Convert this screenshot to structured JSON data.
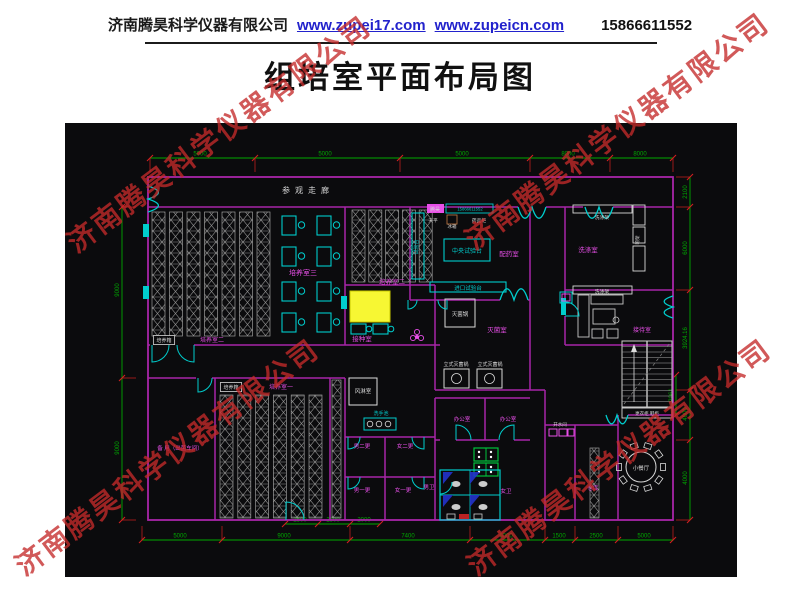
{
  "header": {
    "company": "济南腾昊科学仪器有限公司",
    "links": [
      "www.zupei17.com",
      "www.zupeicn.com"
    ],
    "phone": "15866611552"
  },
  "title": "组培室平面布局图",
  "watermark": {
    "text": "济南腾昊科学仪器有限公司",
    "color": "#c42a2a"
  },
  "plan": {
    "colors": {
      "wall": "#a825a8",
      "cyan": "#00cdcd",
      "dim": "#00a800",
      "tick": "#d42020",
      "white": "#d8d8d8",
      "magenta": "#e84fe8",
      "yellow": "#f7f733",
      "rack": "#9a9a9a",
      "blue": "#2233cc",
      "greenfurn": "#00c23a",
      "canvas": "#0b0b0d"
    },
    "labels": [
      {
        "t": "参观走廊",
        "x": 308,
        "y": 193,
        "c": "w",
        "s": 8,
        "ls": 5
      },
      {
        "t": "培养室三",
        "x": 303,
        "y": 275,
        "c": "m",
        "s": 7
      },
      {
        "t": "培养室二",
        "x": 392,
        "y": 284,
        "c": "m",
        "s": 6.5
      },
      {
        "t": "培养箱",
        "x": 164,
        "y": 342,
        "c": "w",
        "s": 5,
        "box": 1
      },
      {
        "t": "培养室二",
        "x": 212,
        "y": 342,
        "c": "m",
        "s": 6
      },
      {
        "t": "培养箱",
        "x": 231,
        "y": 389,
        "c": "w",
        "s": 5,
        "box": 1
      },
      {
        "t": "培养室一",
        "x": 281,
        "y": 389,
        "c": "m",
        "s": 6
      },
      {
        "t": "备 用（出菌车间）",
        "x": 180,
        "y": 450,
        "c": "m",
        "s": 5.5
      },
      {
        "t": "接种室",
        "x": 362,
        "y": 341,
        "c": "m",
        "s": 6.5
      },
      {
        "t": "灭菌锅",
        "x": 460,
        "y": 316,
        "c": "w",
        "s": 5.5
      },
      {
        "t": "灭菌室",
        "x": 497,
        "y": 332,
        "c": "m",
        "s": 6.5
      },
      {
        "t": "立式灭菌锅",
        "x": 456,
        "y": 366,
        "c": "w",
        "s": 5
      },
      {
        "t": "立式灭菌锅",
        "x": 490,
        "y": 366,
        "c": "w",
        "s": 5
      },
      {
        "t": "配药室",
        "x": 509,
        "y": 256,
        "c": "m",
        "s": 6.5
      },
      {
        "t": "中央试验台",
        "x": 467,
        "y": 253,
        "c": "cy",
        "s": 6
      },
      {
        "t": "进口试验台",
        "x": 468,
        "y": 290,
        "c": "cy",
        "s": 5.5
      },
      {
        "t": "试验台",
        "x": 418,
        "y": 247,
        "c": "cy",
        "s": 5,
        "r": -90
      },
      {
        "t": "天平",
        "x": 433,
        "y": 222,
        "c": "w",
        "s": 4.8
      },
      {
        "t": "冰箱",
        "x": 452,
        "y": 228,
        "c": "w",
        "s": 4.5
      },
      {
        "t": "药品柜",
        "x": 479,
        "y": 222,
        "c": "w",
        "s": 4.8
      },
      {
        "t": "腾昊",
        "x": 435,
        "y": 211,
        "c": "w",
        "s": 5
      },
      {
        "t": "15866611552",
        "x": 470,
        "y": 210.5,
        "c": "cy",
        "s": 4.2
      },
      {
        "t": "洗涤室",
        "x": 588,
        "y": 252,
        "c": "m",
        "s": 6.5
      },
      {
        "t": "洗涤架",
        "x": 602,
        "y": 219,
        "c": "w",
        "s": 4.8
      },
      {
        "t": "洗涤架",
        "x": 602,
        "y": 293,
        "c": "w",
        "s": 4.8
      },
      {
        "t": "晾架",
        "x": 639,
        "y": 240,
        "c": "w",
        "s": 4.5,
        "r": -90
      },
      {
        "t": "接待室",
        "x": 642,
        "y": 332,
        "c": "m",
        "s": 6
      },
      {
        "t": "更衣柜 鞋柜",
        "x": 647,
        "y": 415,
        "c": "w",
        "s": 4.5
      },
      {
        "t": "风淋室",
        "x": 363,
        "y": 393,
        "c": "w",
        "s": 5.5
      },
      {
        "t": "洗手池",
        "x": 381,
        "y": 415,
        "c": "cy",
        "s": 5
      },
      {
        "t": "男二更",
        "x": 362,
        "y": 448,
        "c": "m",
        "s": 5.5
      },
      {
        "t": "女二更",
        "x": 405,
        "y": 448,
        "c": "m",
        "s": 5.5
      },
      {
        "t": "男一更",
        "x": 362,
        "y": 492,
        "c": "m",
        "s": 5.5
      },
      {
        "t": "女一更",
        "x": 403,
        "y": 492,
        "c": "m",
        "s": 5.5
      },
      {
        "t": "办公室",
        "x": 462,
        "y": 421,
        "c": "m",
        "s": 5.5
      },
      {
        "t": "办公室",
        "x": 508,
        "y": 421,
        "c": "m",
        "s": 5.5
      },
      {
        "t": "男卫",
        "x": 429,
        "y": 489,
        "c": "m",
        "s": 5.5
      },
      {
        "t": "女卫",
        "x": 506,
        "y": 493,
        "c": "m",
        "s": 5.5
      },
      {
        "t": "开水间",
        "x": 560,
        "y": 426,
        "c": "w",
        "s": 4.5
      },
      {
        "t": "仓库",
        "x": 593,
        "y": 490,
        "c": "m",
        "s": 5.5
      },
      {
        "t": "小餐厅",
        "x": 641,
        "y": 470,
        "c": "w",
        "s": 5.5
      }
    ],
    "dims": {
      "chains": [
        {
          "dir": "h",
          "pos": 158,
          "from": 150,
          "to": 673,
          "ext": 14,
          "ticks": [
            150,
            255,
            400,
            530,
            610,
            673
          ],
          "labels": [
            {
              "t": "5000",
              "at": 200
            },
            {
              "t": "5000",
              "at": 325
            },
            {
              "t": "5000",
              "at": 462
            },
            {
              "t": "8000",
              "at": 568
            },
            {
              "t": "8000",
              "at": 640
            }
          ]
        },
        {
          "dir": "h",
          "pos": 540,
          "from": 142,
          "to": 673,
          "ext": -14,
          "ticks": [
            142,
            222,
            350,
            470,
            545,
            575,
            618,
            673
          ],
          "labels": [
            {
              "t": "5000",
              "at": 180
            },
            {
              "t": "9000",
              "at": 284
            },
            {
              "t": "7400",
              "at": 408
            },
            {
              "t": "6000",
              "at": 506
            },
            {
              "t": "1500",
              "at": 559
            },
            {
              "t": "2500",
              "at": 596
            },
            {
              "t": "5000",
              "at": 644
            }
          ]
        },
        {
          "dir": "h",
          "pos": 524,
          "from": 285,
          "to": 380,
          "ext": 0,
          "ticks": [
            285,
            318,
            350,
            380
          ],
          "labels": [
            {
              "t": "2500",
              "at": 300
            },
            {
              "t": "2500",
              "at": 333
            },
            {
              "t": "2000",
              "at": 364
            }
          ]
        },
        {
          "dir": "v",
          "pos": 690,
          "from": 177,
          "to": 520,
          "ext": -14,
          "ticks": [
            177,
            207,
            290,
            390,
            440,
            520
          ],
          "labels": [
            {
              "t": "2100",
              "at": 192
            },
            {
              "t": "6000",
              "at": 248
            },
            {
              "t": "3924.16",
              "at": 338
            },
            {
              "t": "4000",
              "at": 414
            },
            {
              "t": "4000",
              "at": 478
            }
          ]
        },
        {
          "dir": "v",
          "pos": 676,
          "from": 375,
          "to": 415,
          "ext": 0,
          "ticks": [
            375,
            415
          ],
          "labels": [
            {
              "t": "2061",
              "at": 395
            }
          ]
        },
        {
          "dir": "v",
          "pos": 122,
          "from": 207,
          "to": 520,
          "ext": 14,
          "ticks": [
            207,
            378,
            520
          ],
          "labels": [
            {
              "t": "9000",
              "at": 290
            },
            {
              "t": "9000",
              "at": 448
            }
          ]
        }
      ]
    }
  }
}
